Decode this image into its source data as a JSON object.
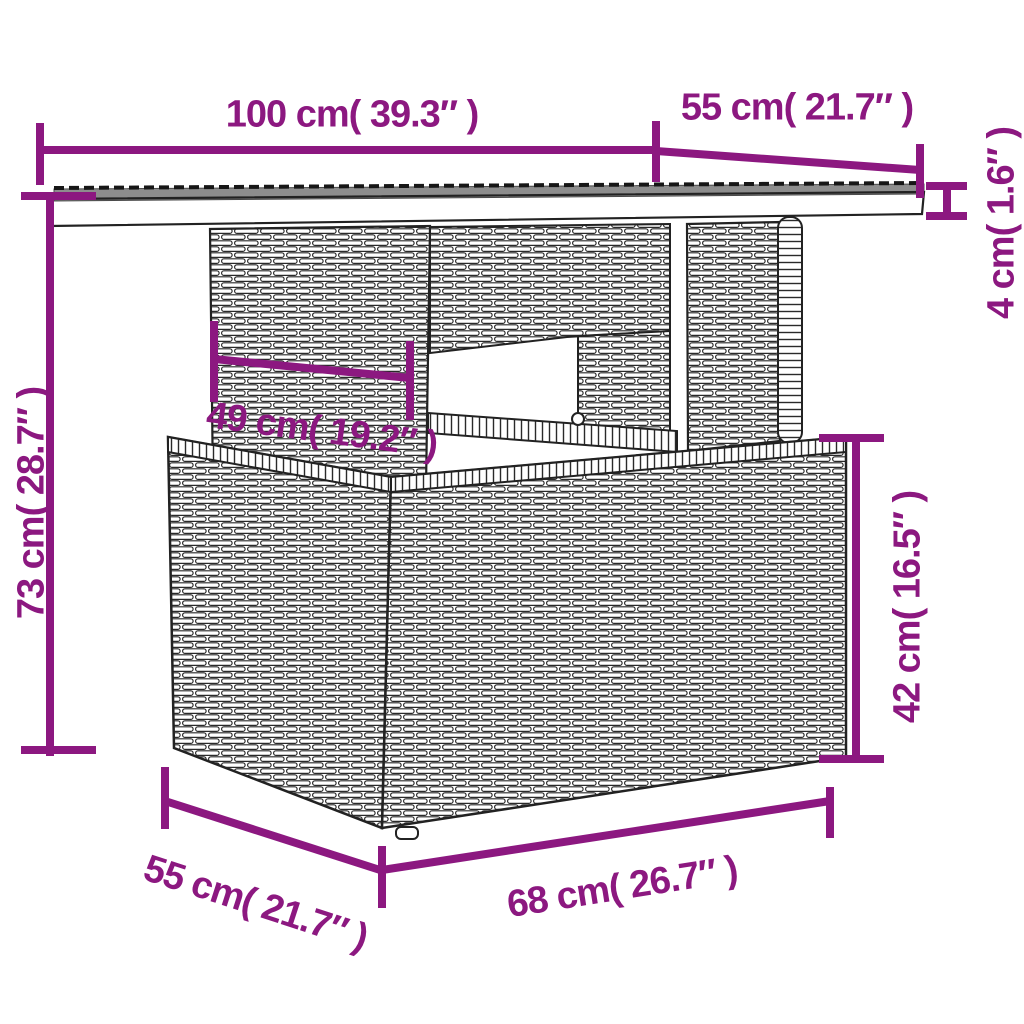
{
  "diagram": {
    "dimensions": {
      "top_width": "100 cm( 39.3″ )",
      "top_depth": "55 cm( 21.7″ )",
      "top_thickness": "4 cm( 1.6″ )",
      "overall_height": "73 cm( 28.7″ )",
      "pedestal_width": "49 cm( 19.2″ )",
      "base_height": "42 cm( 16.5″ )",
      "base_width": "68 cm( 26.7″ )",
      "base_depth": "55 cm( 21.7″ )"
    },
    "colors": {
      "dimension_accent": "#8C1880",
      "line_art": "#222222",
      "glass_top": "#8D8D8D",
      "background": "#FFFFFF"
    }
  }
}
